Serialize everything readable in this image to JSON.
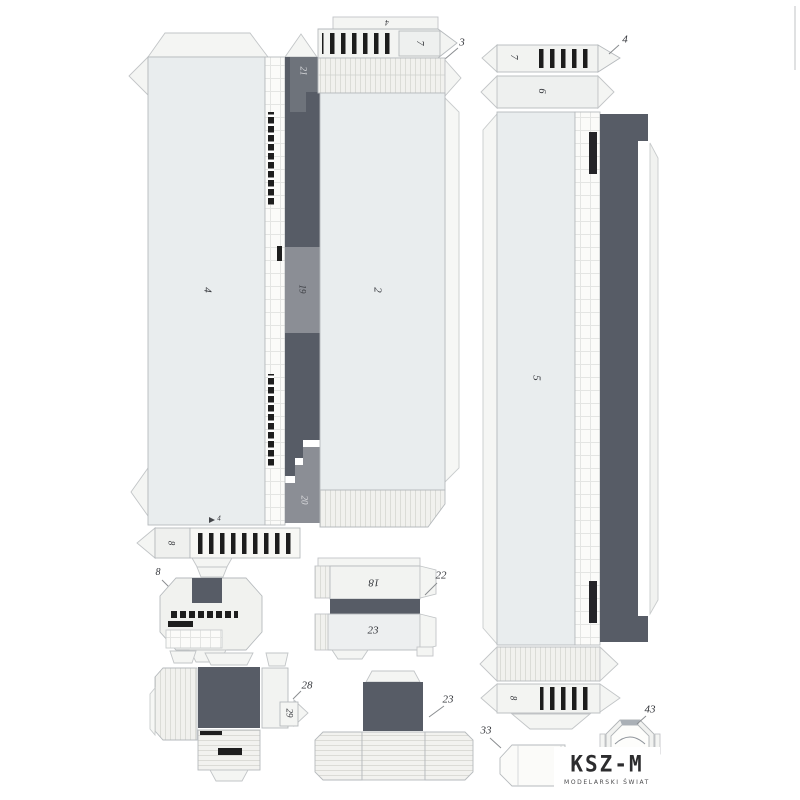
{
  "sheet": {
    "description": "paper model cut-out sheet with numbered parts",
    "colors": {
      "background": "#ffffff",
      "paper_panel": "#e9edee",
      "fold_tab": "#f4f5f3",
      "dark_gray": "#575c66",
      "medium_gray": "#8b8e95",
      "black_detail": "#1e1e1e",
      "outline": "#b6babd"
    }
  },
  "labels": {
    "part2": "2",
    "part3": "3",
    "part4": "4",
    "part5": "5",
    "part6": "6",
    "part7_top": "7",
    "part7_right": "7",
    "part8_strip": "8",
    "part8_small": "8",
    "part8_right": "8",
    "part18": "18",
    "part19": "19",
    "part20": "20",
    "part21": "21",
    "part22": "22",
    "part23_mid": "23",
    "part23_bottom": "23",
    "part28": "28",
    "part29": "29",
    "part33": "33",
    "part43": "43",
    "tab4_top": "4",
    "tab4_right": "4",
    "tab4_strip": "4"
  },
  "logo": {
    "title": "KSZ-M",
    "subtitle": "MODELARSKI ŚWIAT"
  }
}
